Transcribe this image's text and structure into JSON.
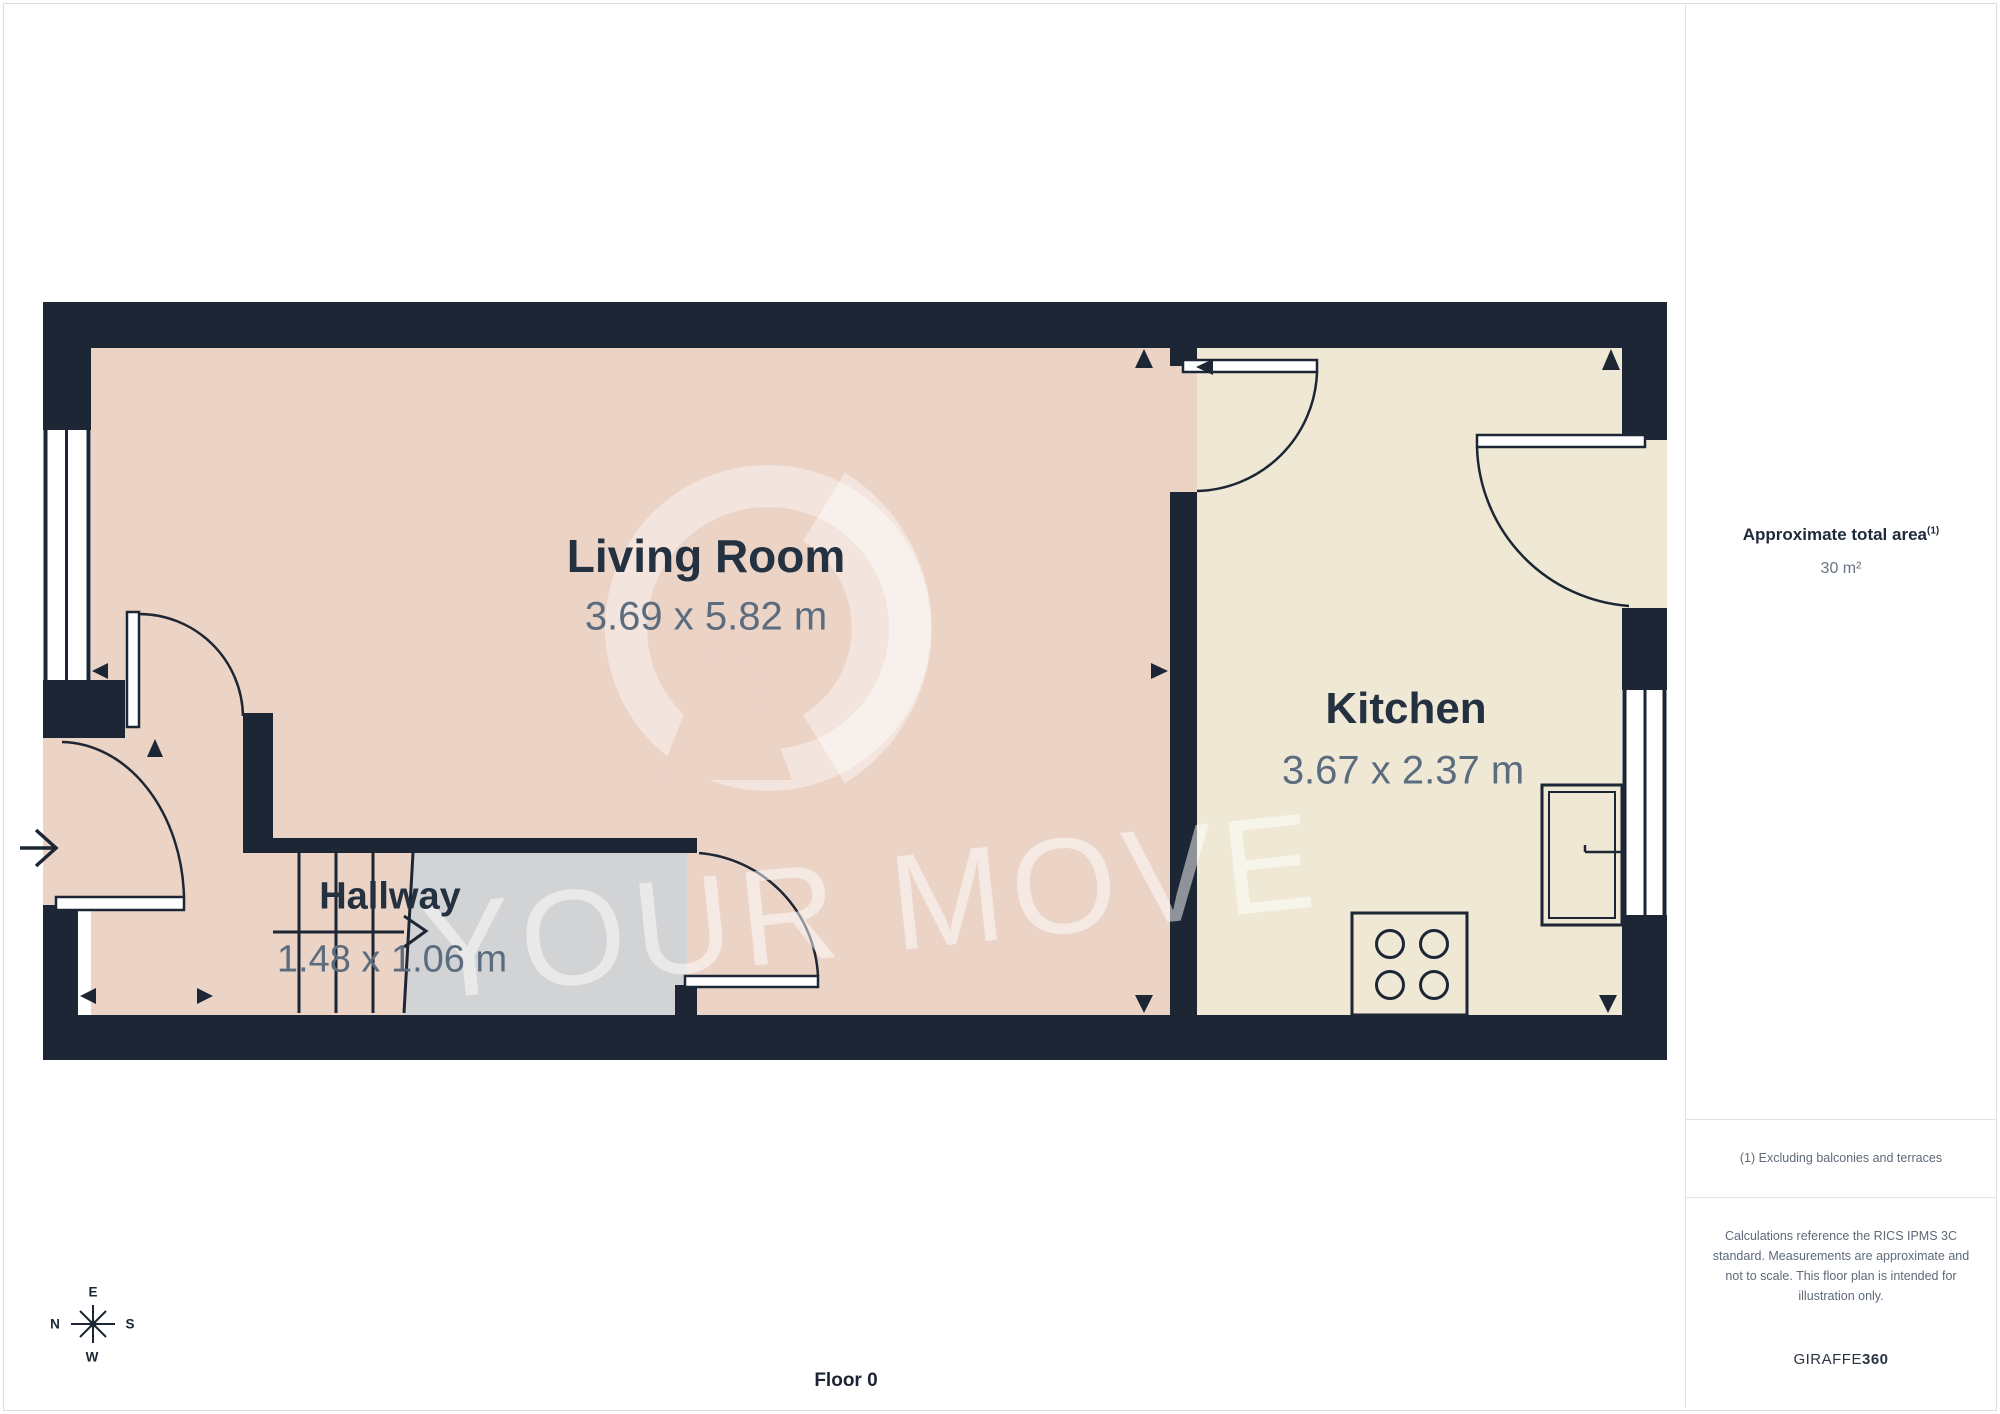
{
  "plan": {
    "rooms": [
      {
        "name": "Living Room",
        "dims": "3.69 x 5.82 m"
      },
      {
        "name": "Kitchen",
        "dims": "3.67 x 2.37 m"
      },
      {
        "name": "Hallway",
        "dims": "1.48 x 1.06 m"
      }
    ],
    "floor_label": "Floor 0",
    "watermark_text": "YOUR MOVE",
    "compass": {
      "n": "N",
      "e": "E",
      "s": "S",
      "w": "W"
    },
    "colors": {
      "wall": "#1D2634",
      "living_room_floor": "#EBD3C6",
      "kitchen_floor": "#EEE8D5",
      "landing_floor": "#D2D3D5",
      "dims_text": "#5C6C7F",
      "label_text": "#233140"
    }
  },
  "sidebar": {
    "area_label": "Approximate total area",
    "area_footnote_marker": "(1)",
    "area_value": "30 m²",
    "footnote": "(1) Excluding balconies and terraces",
    "disclaimer": "Calculations reference the RICS IPMS 3C standard. Measurements are approximate and not to scale. This floor plan is intended for illustration only.",
    "brand_name": "GIRAFFE",
    "brand_suffix": "360"
  }
}
